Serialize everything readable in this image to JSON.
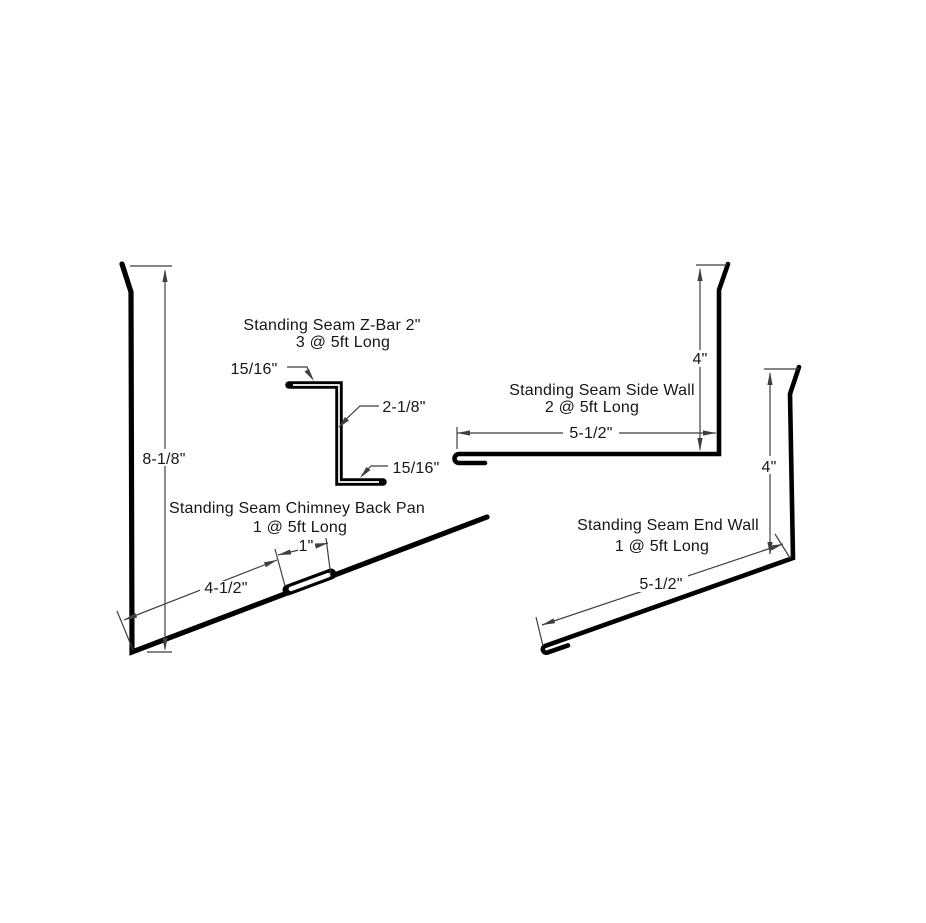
{
  "page": {
    "background": "#ffffff",
    "description": "Standing seam flashing profile shop drawing"
  },
  "drawing": {
    "colors": {
      "profile_line": "#000000",
      "dimension_line": "#3f3f3f",
      "text": "#161616"
    },
    "profiles": {
      "z_bar": {
        "title": "Standing Seam Z-Bar 2\"",
        "quantity": "3 @ 5ft Long",
        "dim_top_hem": "15/16\"",
        "dim_web": "2-1/8\"",
        "dim_bottom_hem": "15/16\""
      },
      "chimney_back_pan": {
        "title": "Standing Seam Chimney Back Pan",
        "quantity": "1 @ 5ft Long",
        "dim_height": "8-1/8\"",
        "dim_base": "4-1/2\"",
        "dim_hem": "1\""
      },
      "side_wall": {
        "title": "Standing Seam Side Wall",
        "quantity": "2 @ 5ft Long",
        "dim_base": "5-1/2\"",
        "dim_rise": "4\""
      },
      "end_wall": {
        "title": "Standing Seam End Wall",
        "quantity": "1 @ 5ft Long",
        "dim_base": "5-1/2\"",
        "dim_rise": "4\""
      }
    }
  }
}
